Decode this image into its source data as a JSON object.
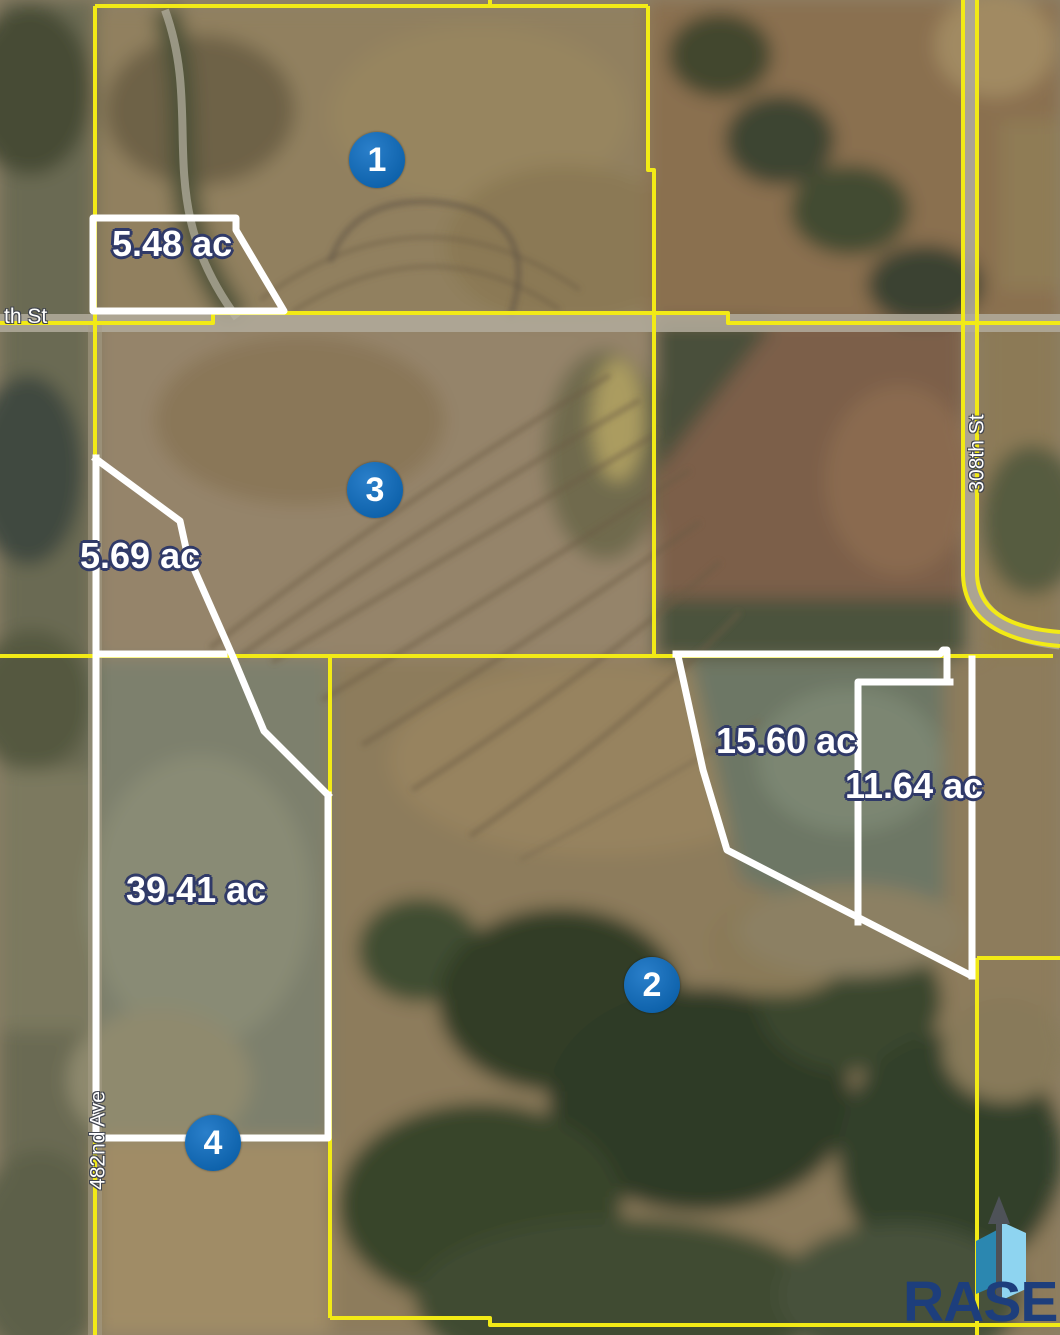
{
  "colors": {
    "parcel_line_yellow": "#f2ea16",
    "boundary_white": "#ffffff",
    "marker_blue": "#0e62ab",
    "label_outline_navy": "#303a68",
    "logo_navy": "#1d3e7c",
    "logo_teal_blue": "#2b87b0",
    "logo_light_blue": "#8ed4f0",
    "logo_arrow_gray": "#4e5258"
  },
  "streets": {
    "west": "th St",
    "east": "308th St",
    "south": "482nd Ave"
  },
  "markers": [
    {
      "number": "1"
    },
    {
      "number": "2"
    },
    {
      "number": "3"
    },
    {
      "number": "4"
    }
  ],
  "acreage_labels": [
    {
      "text": "5.48 ac"
    },
    {
      "text": "5.69 ac"
    },
    {
      "text": "15.60 ac"
    },
    {
      "text": "11.64 ac"
    },
    {
      "text": "39.41 ac"
    }
  ],
  "logo": {
    "name": "RASE"
  }
}
